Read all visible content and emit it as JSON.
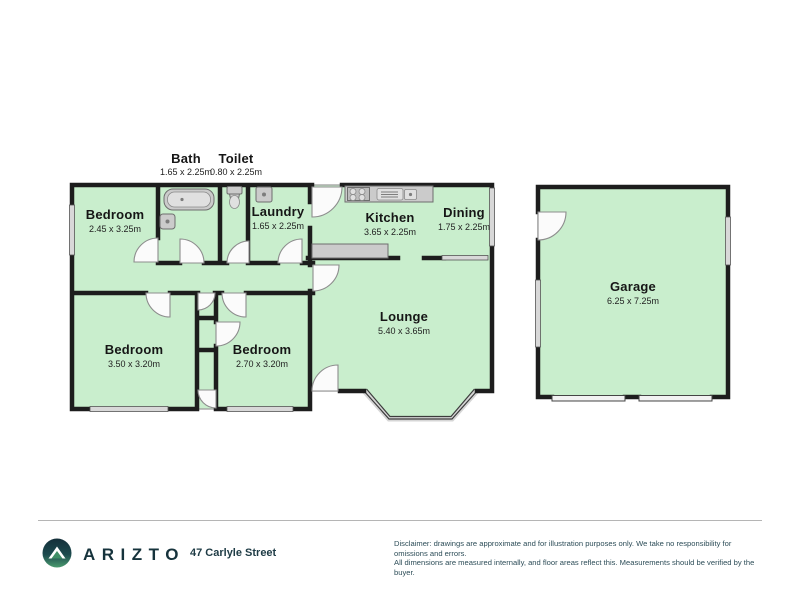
{
  "plan": {
    "rooms": [
      {
        "id": "bedroom-1",
        "name": "Bedroom",
        "dims": "2.45 x 3.25m"
      },
      {
        "id": "bath",
        "name": "Bath",
        "dims": "1.65 x 2.25m"
      },
      {
        "id": "toilet",
        "name": "Toilet",
        "dims": "0.80 x 2.25m"
      },
      {
        "id": "laundry",
        "name": "Laundry",
        "dims": "1.65 x 2.25m"
      },
      {
        "id": "kitchen",
        "name": "Kitchen",
        "dims": "3.65 x 2.25m"
      },
      {
        "id": "dining",
        "name": "Dining",
        "dims": "1.75 x 2.25m"
      },
      {
        "id": "lounge",
        "name": "Lounge",
        "dims": "5.40 x 3.65m"
      },
      {
        "id": "bedroom-2",
        "name": "Bedroom",
        "dims": "3.50 x 3.20m"
      },
      {
        "id": "bedroom-3",
        "name": "Bedroom",
        "dims": "2.70 x 3.20m"
      },
      {
        "id": "garage",
        "name": "Garage",
        "dims": "6.25 x 7.25m"
      }
    ],
    "fixtures": [
      "bathtub",
      "toilet-pan",
      "bath-sink",
      "laundry-tub",
      "stove",
      "kitchen-sink",
      "kitchen-bench"
    ],
    "colors": {
      "floor": "#c9eecd",
      "wall": "#1d1d1d",
      "window": "#d8d8d8",
      "fixture": "#cbcbcb"
    }
  },
  "footer": {
    "brand": "ARIZTO",
    "address": "47 Carlyle Street",
    "disclaimer_line1": "Disclaimer: drawings are approximate and for illustration purposes only. We take no responsibility for omissions and errors.",
    "disclaimer_line2": "All dimensions are measured internally, and floor areas reflect this. Measurements should be verified by the buyer."
  }
}
